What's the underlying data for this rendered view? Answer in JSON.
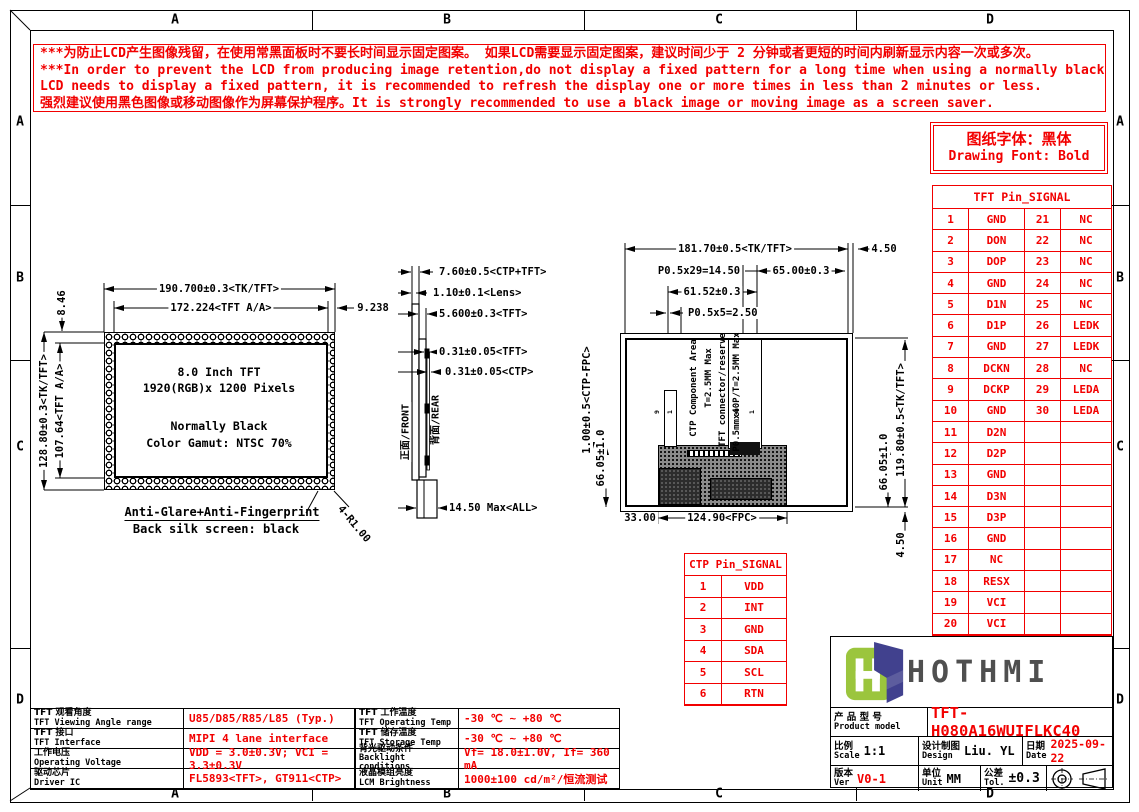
{
  "colors": {
    "red": "#f20000",
    "line_black": "#000000",
    "logo_green": "#9bc53d",
    "logo_navy": "#41418e"
  },
  "frame": {
    "zones": [
      "A",
      "B",
      "C",
      "D"
    ]
  },
  "warning": {
    "lines": [
      "***为防止LCD产生图像残留，在使用常黑面板时不要长时间显示固定图案。 如果LCD需要显示固定图案，建议时间少于 2 分钟或者更短的时间内刷新显示内容一次或多次。",
      "***In order to prevent the LCD from producing image retention,do not display a fixed pattern for a long time when using a normally black panel.If the",
      " LCD needs to display a fixed pattern, it is recommended to refresh the display one or more times in less than 2 minutes or less.",
      "强烈建议使用黑色图像或移动图像作为屏幕保护程序。It is strongly recommended to use a black image or moving image as a screen saver."
    ]
  },
  "font_note": {
    "line1": "图纸字体：黑体",
    "line2": "Drawing Font: Bold"
  },
  "tft_pin_table": {
    "title": "TFT Pin_SIGNAL",
    "rows": [
      {
        "p1": "1",
        "s1": "GND",
        "p2": "21",
        "s2": "NC"
      },
      {
        "p1": "2",
        "s1": "DON",
        "p2": "22",
        "s2": "NC"
      },
      {
        "p1": "3",
        "s1": "DOP",
        "p2": "23",
        "s2": "NC"
      },
      {
        "p1": "4",
        "s1": "GND",
        "p2": "24",
        "s2": "NC"
      },
      {
        "p1": "5",
        "s1": "D1N",
        "p2": "25",
        "s2": "NC"
      },
      {
        "p1": "6",
        "s1": "D1P",
        "p2": "26",
        "s2": "LEDK"
      },
      {
        "p1": "7",
        "s1": "GND",
        "p2": "27",
        "s2": "LEDK"
      },
      {
        "p1": "8",
        "s1": "DCKN",
        "p2": "28",
        "s2": "NC"
      },
      {
        "p1": "9",
        "s1": "DCKP",
        "p2": "29",
        "s2": "LEDA"
      },
      {
        "p1": "10",
        "s1": "GND",
        "p2": "30",
        "s2": "LEDA"
      },
      {
        "p1": "11",
        "s1": "D2N",
        "p2": "",
        "s2": ""
      },
      {
        "p1": "12",
        "s1": "D2P",
        "p2": "",
        "s2": ""
      },
      {
        "p1": "13",
        "s1": "GND",
        "p2": "",
        "s2": ""
      },
      {
        "p1": "14",
        "s1": "D3N",
        "p2": "",
        "s2": ""
      },
      {
        "p1": "15",
        "s1": "D3P",
        "p2": "",
        "s2": ""
      },
      {
        "p1": "16",
        "s1": "GND",
        "p2": "",
        "s2": ""
      },
      {
        "p1": "17",
        "s1": "NC",
        "p2": "",
        "s2": ""
      },
      {
        "p1": "18",
        "s1": "RESX",
        "p2": "",
        "s2": ""
      },
      {
        "p1": "19",
        "s1": "VCI",
        "p2": "",
        "s2": ""
      },
      {
        "p1": "20",
        "s1": "VCI",
        "p2": "",
        "s2": ""
      }
    ]
  },
  "ctp_pin_table": {
    "title": "CTP Pin_SIGNAL",
    "rows": [
      {
        "pin": "1",
        "signal": "VDD"
      },
      {
        "pin": "2",
        "signal": "INT"
      },
      {
        "pin": "3",
        "signal": "GND"
      },
      {
        "pin": "4",
        "signal": "SDA"
      },
      {
        "pin": "5",
        "signal": "SCL"
      },
      {
        "pin": "6",
        "signal": "RTN"
      }
    ]
  },
  "spec_left": {
    "rows": [
      {
        "cn": "TFT 观看角度",
        "en": "TFT Viewing Angle range",
        "value": "U85/D85/R85/L85 (Typ.)"
      },
      {
        "cn": "TFT 接口",
        "en": "TFT Interface",
        "value": "MIPI 4 lane interface"
      },
      {
        "cn": "工作电压",
        "en": "Operating Voltage",
        "value": "VDD = 3.0±0.3V; VCI = 3.3±0.3V"
      },
      {
        "cn": "驱动芯片",
        "en": "Driver IC",
        "value": "FL5893<TFT>, GT911<CTP>"
      }
    ]
  },
  "spec_mid": {
    "rows": [
      {
        "cn": "TFT 工作温度",
        "en": "TFT Operating Temp",
        "value": "-30 ℃ ~ +80 ℃"
      },
      {
        "cn": "TFT 储存温度",
        "en": "TFT Storage Temp",
        "value": "-30 ℃ ~ +80 ℃"
      },
      {
        "cn": "背光驱动条件",
        "en": "Backlight conditions",
        "value": "Vf= 18.0±1.0V, If= 360 mA"
      },
      {
        "cn": "液晶模组亮度",
        "en": "LCM Brightness",
        "value": "1000±100 cd/m²/恒流测试"
      }
    ]
  },
  "title_block": {
    "logo_text": "HOTHMI",
    "product_label_cn": "产 品 型 号",
    "product_label_en": "Product model",
    "product_model": "TFT-H080A16WUIFLKC40",
    "scale_cn": "比例",
    "scale_en": "Scale",
    "scale": "1:1",
    "design_cn": "设计制图",
    "design_en": "Design",
    "designer": "Liu. YL",
    "date_cn": "日期",
    "date_en": "Date",
    "date": "2025-09-22",
    "ver_cn": "版本",
    "ver_en": "Ver",
    "version": "V0-1",
    "unit_cn": "单位",
    "unit_en": "Unit",
    "unit": "MM",
    "tol_cn": "公差",
    "tol_en": "Tol.",
    "tolerance": "±0.3"
  },
  "front_view": {
    "dim_width_outer": "190.700±0.3<TK/TFT>",
    "dim_width_aa": "172.224<TFT A/A>",
    "dim_right": "9.238",
    "dim_top_left": "8.46",
    "dim_height_outer": "128.80±0.3<TK/TFT>",
    "dim_height_aa": "107.64<TFT A/A>",
    "line1": "8.0 Inch TFT",
    "line2": "1920(RGB)x 1200 Pixels",
    "line3": "Normally Black",
    "line4": "Color Gamut: NTSC 70%",
    "note1": "Anti-Glare+Anti-Fingerprint",
    "note2": "Back silk screen: black",
    "corner": "4-R1.00"
  },
  "side_view": {
    "dims": [
      "7.60±0.5<CTP+TFT>",
      "1.10±0.1<Lens>",
      "5.600±0.3<TFT>",
      "0.31±0.05<TFT>",
      "0.31±0.05<CTP>",
      "14.50 Max<ALL>"
    ],
    "front_label": "正面/FRONT",
    "rear_label": "背面/REAR"
  },
  "rear_view": {
    "dim_width": "181.70±0.5<TK/TFT>",
    "dim_right_gap": "4.50",
    "dim_pitch29": "P0.5x29=14.50",
    "dim_65": "65.00±0.3",
    "dim_6152": "61.52±0.3",
    "dim_pitch5": "P0.5x5=2.50",
    "dim_ctp_fpc": "1.00±0.5<CTP-FPC>",
    "dim_6605_l": "66.05±1.0",
    "dim_6605_r": "66.05±1.0",
    "dim_height": "119.80±0.5<TK/TFT>",
    "dim_450_b": "4.50",
    "dim_33": "33.00",
    "dim_fpc": "124.90<FPC>",
    "label_ctp_area": "CTP Component Area",
    "label_t25": "T=2.5MM Max",
    "label_tft_conn": "TFT connector/reserve",
    "label_p05": "P0.5mmx40P/T=2.5MM Max",
    "tft_pin_end": "30",
    "tft_pin_start": "1",
    "ctp_pin_a": "9",
    "ctp_pin_b": "1"
  }
}
